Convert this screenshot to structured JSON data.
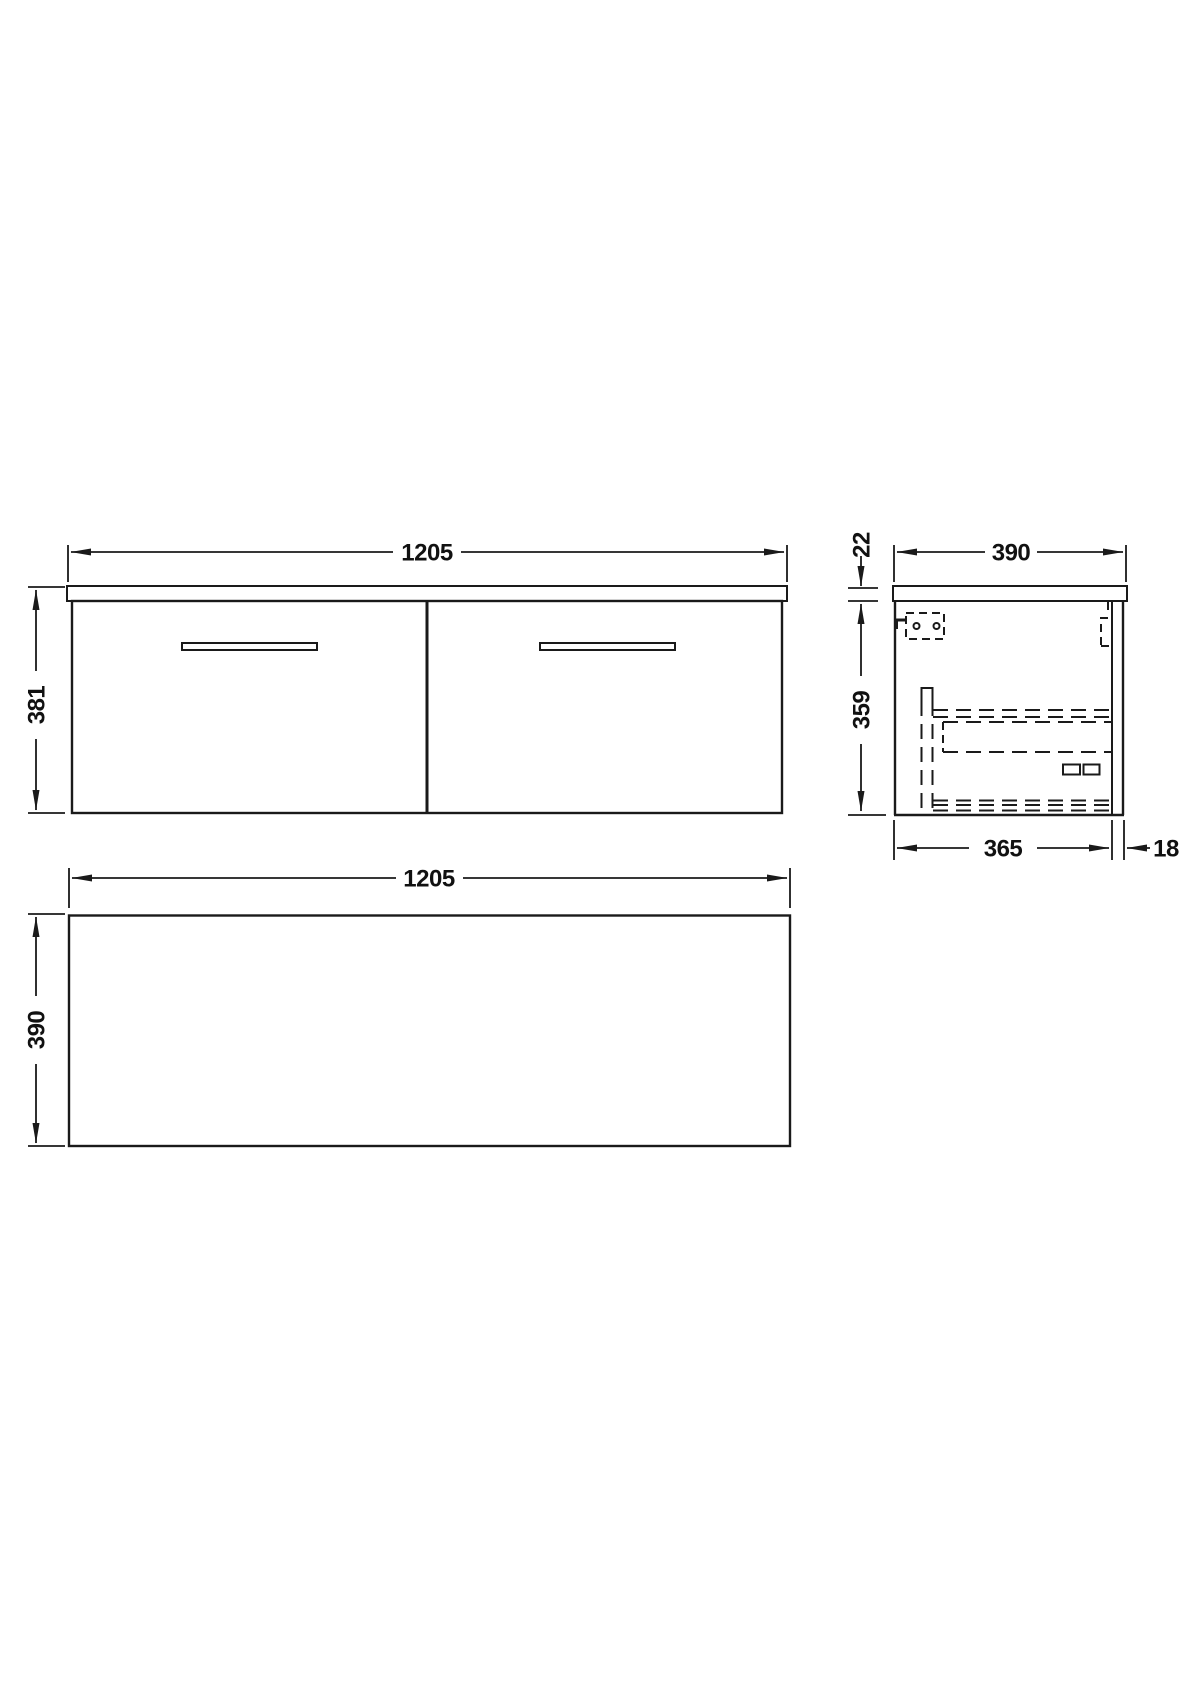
{
  "drawing": {
    "background_color": "#ffffff",
    "line_color": "#1a1a1a",
    "views": {
      "front": {
        "name": "front-view",
        "width": "1205",
        "height": "381"
      },
      "side": {
        "name": "side-view",
        "worktop_width": "390",
        "worktop_thickness": "22",
        "body_height": "359",
        "body_depth": "365",
        "back_panel_offset": "18"
      },
      "plan": {
        "name": "plan-view",
        "width": "1205",
        "depth": "390"
      }
    }
  }
}
